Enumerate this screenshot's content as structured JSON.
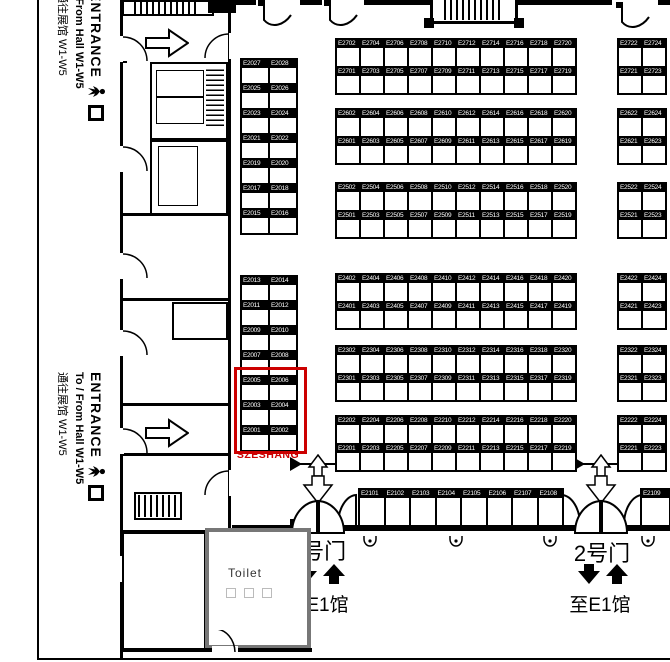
{
  "colors": {
    "highlight": "#cc0000",
    "wall": "#000000",
    "toilet_wall": "#777777"
  },
  "entrances": {
    "top": {
      "title": "ENTRANCE",
      "line_en": "/ From Hall W1-W5",
      "line_zh": "通往展馆 W1-W5"
    },
    "mid": {
      "title": "ENTRANCE",
      "line_en": "To / From Hall W1-W5",
      "line_zh": "通往展馆 W1-W5"
    }
  },
  "gates": {
    "gate1": {
      "name": "1号门",
      "direction": "至E1馆"
    },
    "gate2": {
      "name": "2号门",
      "direction": "至E1馆"
    }
  },
  "toilet": {
    "label": "Toilet"
  },
  "highlight": {
    "label": "SZESHANG"
  },
  "booth_blocks": [
    {
      "id": "left-top",
      "x": 240,
      "y": 58,
      "cellW": 28,
      "rowH": 25,
      "rows": [
        [
          "E2027",
          "E2028"
        ],
        [
          "E2025",
          "E2026"
        ],
        [
          "E2023",
          "E2024"
        ],
        [
          "E2021",
          "E2022"
        ],
        [
          "E2019",
          "E2020"
        ],
        [
          "E2017",
          "E2018"
        ],
        [
          "E2015",
          "E2016"
        ]
      ]
    },
    {
      "id": "left-bottom",
      "x": 240,
      "y": 275,
      "cellW": 28,
      "rowH": 25,
      "rows": [
        [
          "E2013",
          "E2014"
        ],
        [
          "E2011",
          "E2012"
        ],
        [
          "E2009",
          "E2010"
        ],
        [
          "E2007",
          "E2008"
        ],
        [
          "E2005",
          "E2006"
        ],
        [
          "E2003",
          "E2004"
        ],
        [
          "E2001",
          "E2002"
        ]
      ]
    },
    {
      "id": "main-e27",
      "x": 335,
      "y": 38,
      "cellW": 24,
      "rowH": 27.5,
      "rows": [
        [
          "E2702",
          "E2704",
          "E2706",
          "E2708",
          "E2710",
          "E2712",
          "E2714",
          "E2716",
          "E2718",
          "E2720"
        ],
        [
          "E2701",
          "E2703",
          "E2705",
          "E2707",
          "E2709",
          "E2711",
          "E2713",
          "E2715",
          "E2717",
          "E2719"
        ]
      ]
    },
    {
      "id": "main-e26",
      "x": 335,
      "y": 108,
      "cellW": 24,
      "rowH": 27.5,
      "rows": [
        [
          "E2602",
          "E2604",
          "E2606",
          "E2608",
          "E2610",
          "E2612",
          "E2614",
          "E2616",
          "E2618",
          "E2620"
        ],
        [
          "E2601",
          "E2603",
          "E2605",
          "E2607",
          "E2609",
          "E2611",
          "E2613",
          "E2615",
          "E2617",
          "E2619"
        ]
      ]
    },
    {
      "id": "main-e25",
      "x": 335,
      "y": 182,
      "cellW": 24,
      "rowH": 27.5,
      "rows": [
        [
          "E2502",
          "E2504",
          "E2506",
          "E2508",
          "E2510",
          "E2512",
          "E2514",
          "E2516",
          "E2518",
          "E2520"
        ],
        [
          "E2501",
          "E2503",
          "E2505",
          "E2507",
          "E2509",
          "E2511",
          "E2513",
          "E2515",
          "E2517",
          "E2519"
        ]
      ]
    },
    {
      "id": "main-e24",
      "x": 335,
      "y": 273,
      "cellW": 24,
      "rowH": 27.5,
      "rows": [
        [
          "E2402",
          "E2404",
          "E2406",
          "E2408",
          "E2410",
          "E2412",
          "E2414",
          "E2416",
          "E2418",
          "E2420"
        ],
        [
          "E2401",
          "E2403",
          "E2405",
          "E2407",
          "E2409",
          "E2411",
          "E2413",
          "E2415",
          "E2417",
          "E2419"
        ]
      ]
    },
    {
      "id": "main-e23",
      "x": 335,
      "y": 345,
      "cellW": 24,
      "rowH": 27.5,
      "rows": [
        [
          "E2302",
          "E2304",
          "E2306",
          "E2308",
          "E2310",
          "E2312",
          "E2314",
          "E2316",
          "E2318",
          "E2320"
        ],
        [
          "E2301",
          "E2303",
          "E2305",
          "E2307",
          "E2309",
          "E2311",
          "E2313",
          "E2315",
          "E2317",
          "E2319"
        ]
      ]
    },
    {
      "id": "main-e22",
      "x": 335,
      "y": 415,
      "cellW": 24,
      "rowH": 27.5,
      "rows": [
        [
          "E2202",
          "E2204",
          "E2206",
          "E2208",
          "E2210",
          "E2212",
          "E2214",
          "E2216",
          "E2218",
          "E2220"
        ],
        [
          "E2201",
          "E2203",
          "E2205",
          "E2207",
          "E2209",
          "E2211",
          "E2213",
          "E2215",
          "E2217",
          "E2219"
        ]
      ]
    },
    {
      "id": "right-e27",
      "x": 617,
      "y": 38,
      "cellW": 24,
      "rowH": 27.5,
      "rows": [
        [
          "E2722",
          "E2724"
        ],
        [
          "E2721",
          "E2723"
        ]
      ]
    },
    {
      "id": "right-e26",
      "x": 617,
      "y": 108,
      "cellW": 24,
      "rowH": 27.5,
      "rows": [
        [
          "E2622",
          "E2624"
        ],
        [
          "E2621",
          "E2623"
        ]
      ]
    },
    {
      "id": "right-e25",
      "x": 617,
      "y": 182,
      "cellW": 24,
      "rowH": 27.5,
      "rows": [
        [
          "E2522",
          "E2524"
        ],
        [
          "E2521",
          "E2523"
        ]
      ]
    },
    {
      "id": "right-e24",
      "x": 617,
      "y": 273,
      "cellW": 24,
      "rowH": 27.5,
      "rows": [
        [
          "E2422",
          "E2424"
        ],
        [
          "E2421",
          "E2423"
        ]
      ]
    },
    {
      "id": "right-e23",
      "x": 617,
      "y": 345,
      "cellW": 24,
      "rowH": 27.5,
      "rows": [
        [
          "E2322",
          "E2324"
        ],
        [
          "E2321",
          "E2323"
        ]
      ]
    },
    {
      "id": "right-e22",
      "x": 617,
      "y": 415,
      "cellW": 24,
      "rowH": 27.5,
      "rows": [
        [
          "E2222",
          "E2224"
        ],
        [
          "E2221",
          "E2223"
        ]
      ]
    },
    {
      "id": "south-row",
      "x": 358,
      "y": 488,
      "cellW": 25.5,
      "rowH": 37,
      "rows": [
        [
          "E2101",
          "E2102",
          "E2103",
          "E2104",
          "E2105",
          "E2106",
          "E2107",
          "E2108"
        ]
      ]
    },
    {
      "id": "south-row-2",
      "x": 640,
      "y": 488,
      "cellW": 29,
      "rowH": 37,
      "rows": [
        [
          "E2109"
        ]
      ]
    }
  ]
}
